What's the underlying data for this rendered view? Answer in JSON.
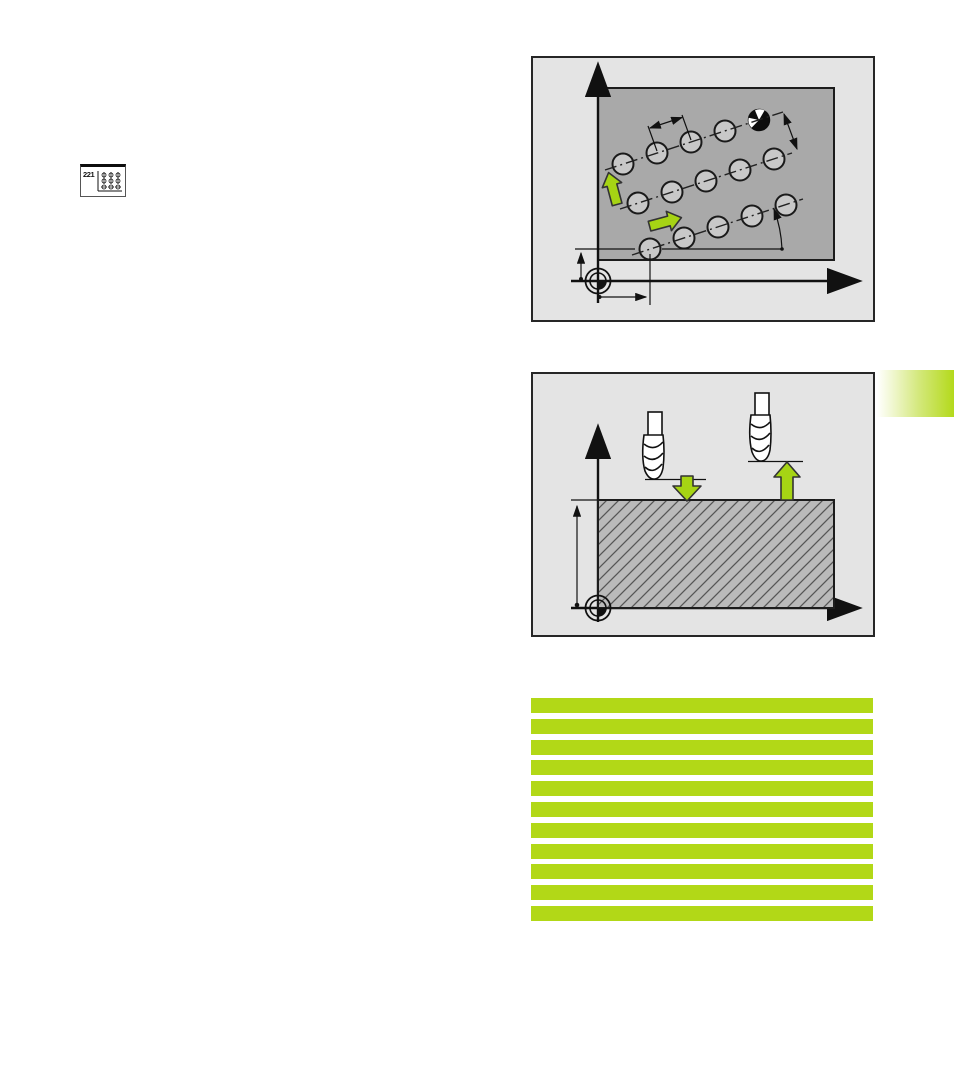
{
  "page": {
    "kind": "manual-page",
    "background": "#ffffff"
  },
  "softkey": {
    "label": "221",
    "icon": "cycle-221-pattern-of-points-on-lines-icon"
  },
  "colors": {
    "highlight_green": "#b2d817",
    "arrow_green": "#a6d414",
    "tab_green": "#b7db25",
    "panel_bg": "#e4e4e4",
    "workpiece_gray": "#a9a9a9",
    "section_gray": "#bababa",
    "line_dark": "#1a1a1a"
  },
  "figures": [
    {
      "name": "hole-pattern-on-lines-diagram",
      "icons": [
        "y-axis-arrow-icon",
        "x-axis-arrow-icon",
        "datum-symbol-icon",
        "green-up-arrow-icon",
        "green-right-arrow-icon",
        "reference-hole-icon"
      ],
      "hole_rows": 3,
      "holes_per_row": 5
    },
    {
      "name": "tool-infeed-retract-diagram",
      "icons": [
        "y-axis-arrow-icon",
        "x-axis-arrow-icon",
        "datum-symbol-icon",
        "end-mill-tool-icon",
        "green-down-arrow-icon",
        "green-up-arrow-icon"
      ]
    }
  ],
  "section_tab": {
    "present": true
  },
  "highlight_bars": {
    "count": 11
  }
}
